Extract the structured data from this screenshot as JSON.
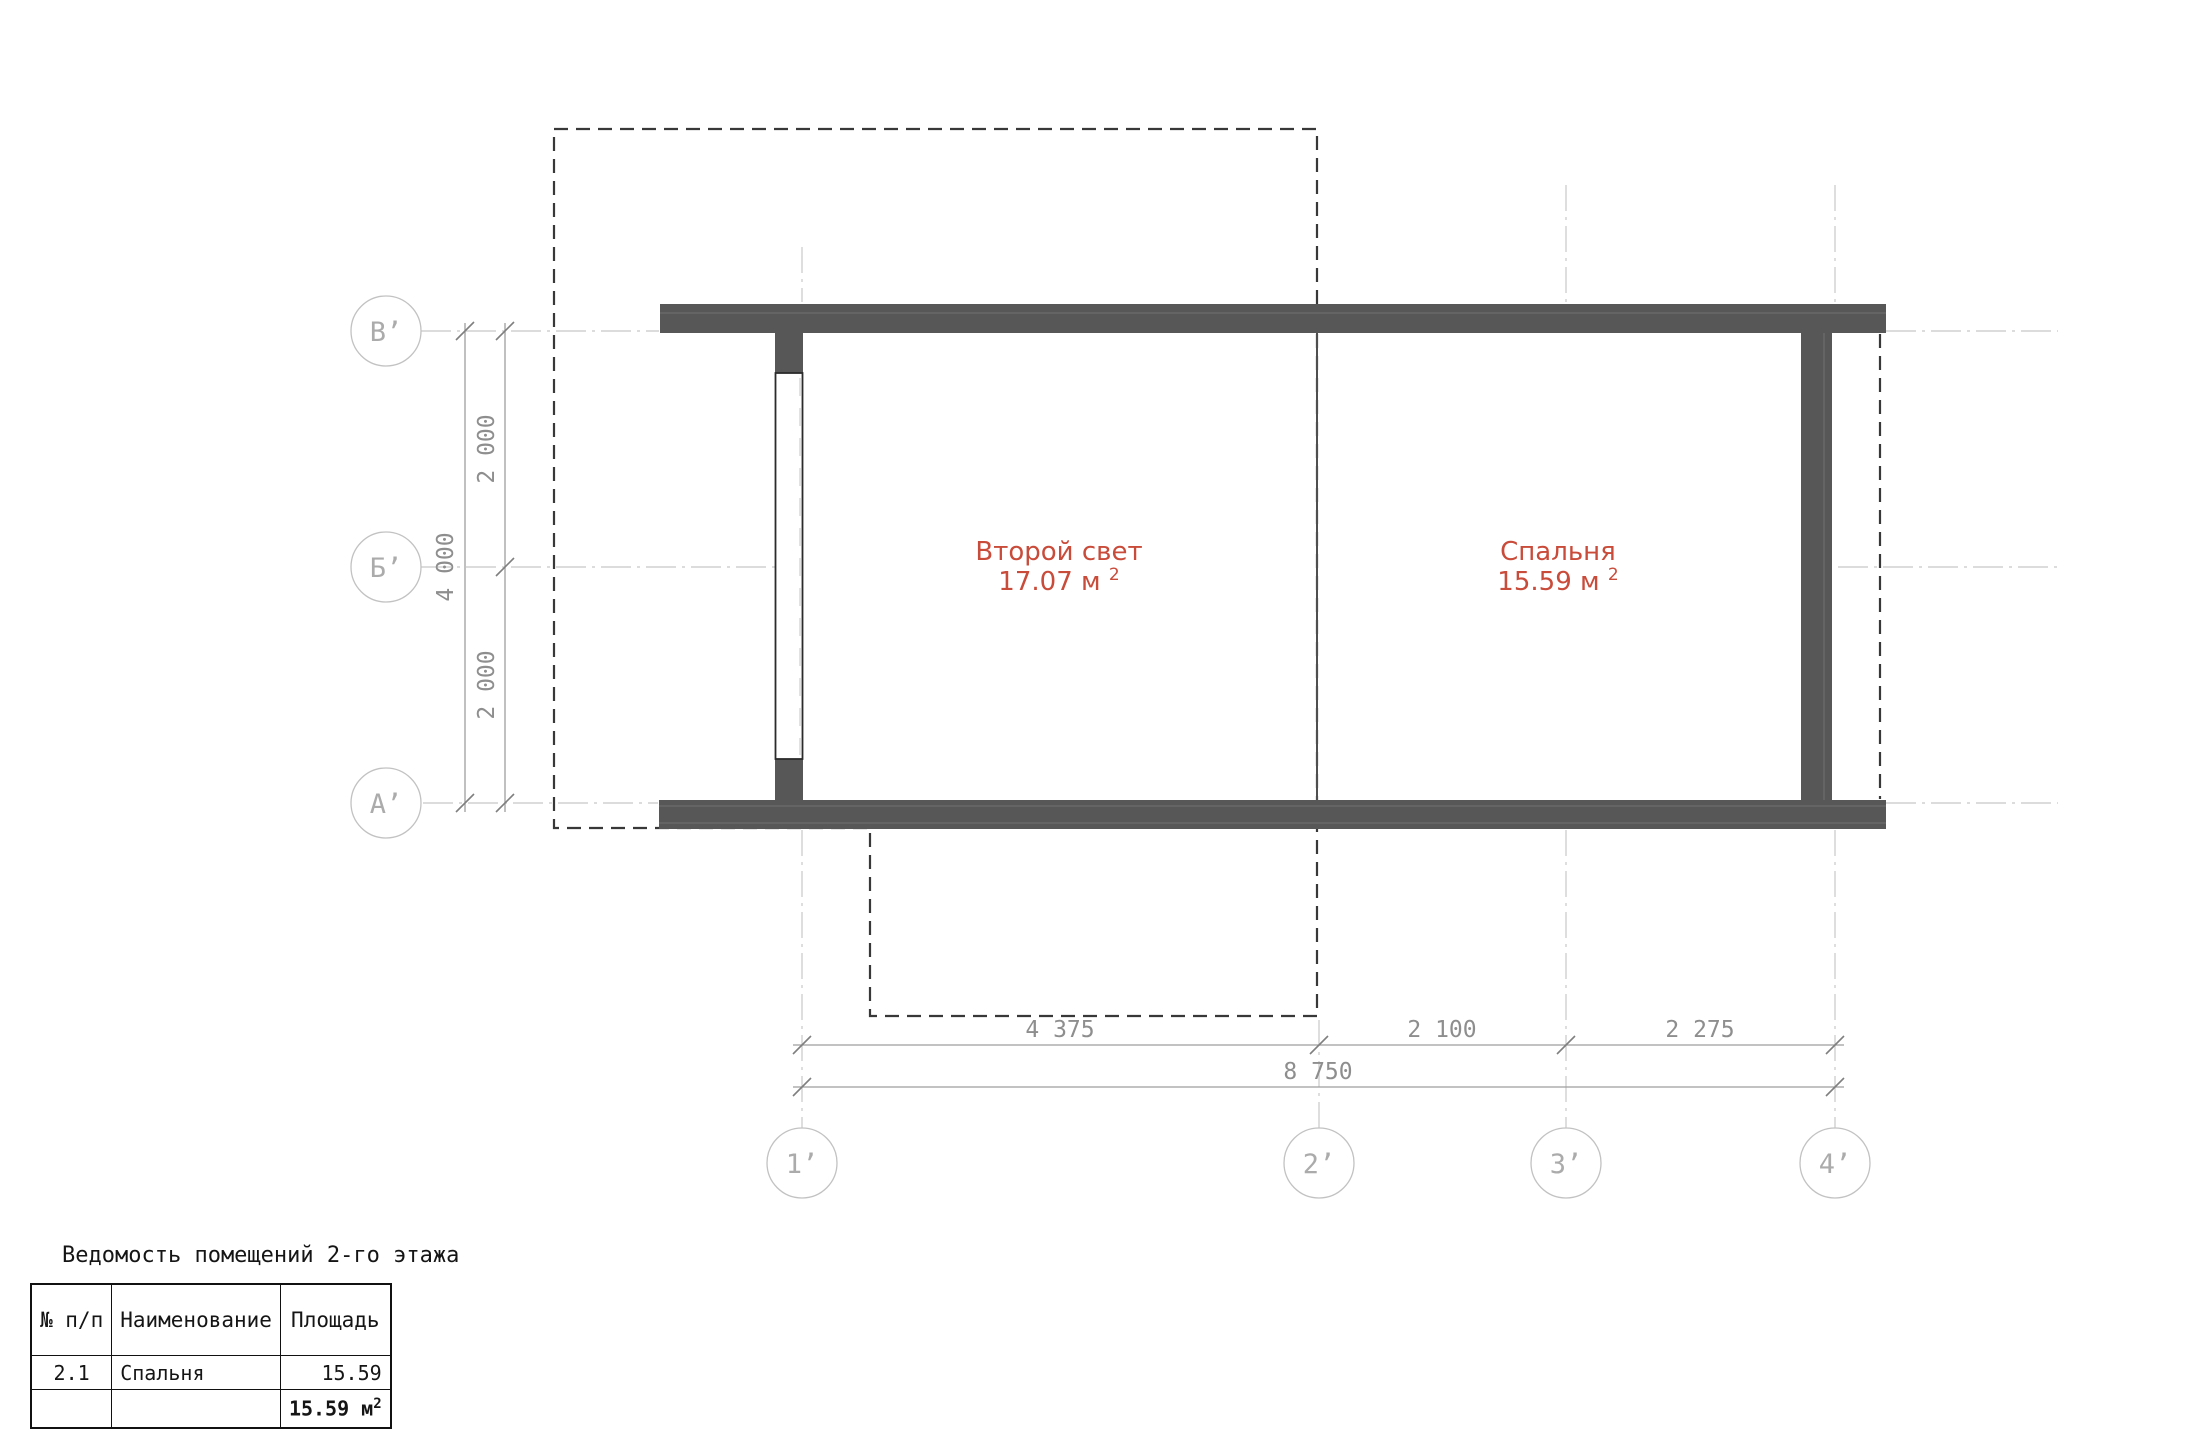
{
  "drawing": {
    "axes_left": [
      {
        "label": "В’"
      },
      {
        "label": "Б’"
      },
      {
        "label": "А’"
      }
    ],
    "axes_bottom": [
      {
        "label": "1’"
      },
      {
        "label": "2’"
      },
      {
        "label": "3’"
      },
      {
        "label": "4’"
      }
    ],
    "dimensions": {
      "v_total": "4 000",
      "v_seg1": "2 000",
      "v_seg2": "2 000",
      "h_seg1": "4 375",
      "h_seg2": "2 100",
      "h_seg3": "2 275",
      "h_total": "8 750"
    },
    "rooms": [
      {
        "name": "Второй свет",
        "area": "17.07 м",
        "area_sup": "2"
      },
      {
        "name": "Спальня",
        "area": "15.59 м",
        "area_sup": "2"
      }
    ]
  },
  "schedule": {
    "title": "Ведомость помещений 2-го этажа",
    "headers": [
      "№ п/п",
      "Наименование",
      "Площадь"
    ],
    "rows": [
      {
        "num": "2.1",
        "name": "Спальня",
        "area": "15.59"
      }
    ],
    "total": "15.59 м",
    "total_sup": "2"
  },
  "colors": {
    "wall": "#575757",
    "room_label": "#c94b3a"
  }
}
